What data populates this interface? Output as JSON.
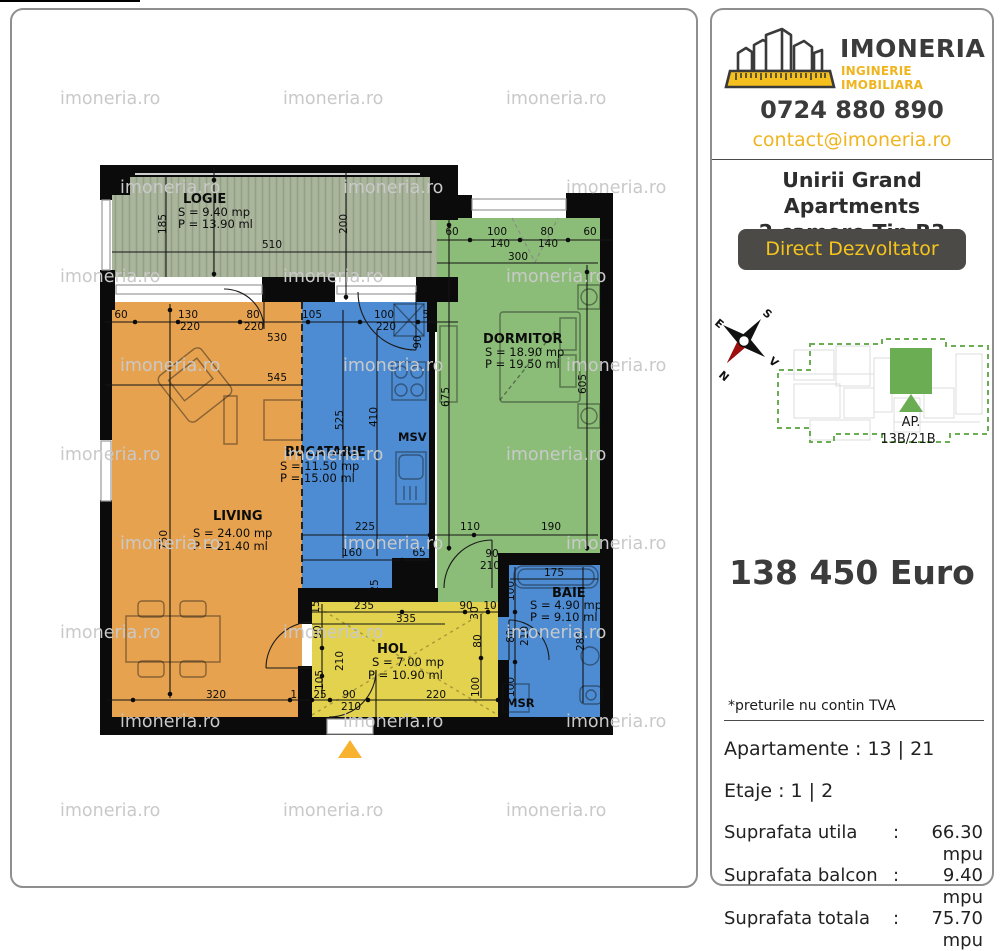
{
  "watermark": {
    "text": "imoneria.ro"
  },
  "sidebar": {
    "brand": {
      "name": "IMONERIA",
      "tagline": "INGINERIE IMOBILIARA"
    },
    "phone": "0724 880 890",
    "email": "contact@imoneria.ro",
    "project_title_line1": "Unirii Grand Apartments",
    "project_title_line2": "2 camere Tip B3",
    "badge_label": "Direct Dezvoltator",
    "compass": {
      "n": "N",
      "s": "S",
      "e": "E",
      "v": "V"
    },
    "minimap": {
      "ap_line1": "AP.",
      "ap_line2": "13B/21B"
    },
    "price": "138 450 Euro",
    "tva_note": "*preturile nu contin TVA",
    "apartments_row": "Apartamente : 13 | 21",
    "floors_row": "Etaje : 1 | 2",
    "areas": [
      {
        "label": "Suprafata utila",
        "colon": ":",
        "value": "66.30 mpu"
      },
      {
        "label": "Suprafata balcon",
        "colon": ":",
        "value": "9.40 mpu"
      },
      {
        "label": "Suprafata totala",
        "colon": ":",
        "value": "75.70 mpu"
      }
    ],
    "colors": {
      "accent_yellow": "#f0b41e",
      "dark_gray": "#4b4a47",
      "map_green": "#6aad53"
    }
  },
  "floorplan": {
    "rooms": [
      {
        "name": "LOGIE",
        "area": "S = 9.40 mp",
        "perimeter": "P = 13.90 ml",
        "color": "#aab59c"
      },
      {
        "name": "DORMITOR",
        "area": "S = 18.90 mp",
        "perimeter": "P = 19.50 ml",
        "color": "#8cbd78"
      },
      {
        "name": "BUCATARIE",
        "area": "S = 11.50 mp",
        "perimeter": "P = 15.00 ml",
        "color": "#4d8cd3"
      },
      {
        "name": "LIVING",
        "area": "S = 24.00 mp",
        "perimeter": "P = 21.40 ml",
        "color": "#e6a24f"
      },
      {
        "name": "HOL",
        "area": "S = 7.00 mp",
        "perimeter": "P = 10.90 ml",
        "color": "#e2d24d"
      },
      {
        "name": "BAIE",
        "area": "S = 4.90 mp",
        "perimeter": "P = 9.10 ml",
        "color": "#4d8cd3"
      }
    ],
    "annotations": {
      "msv": "MSV",
      "msr": "MSR"
    },
    "dimensions": [
      {
        "t": "185",
        "x": 166,
        "y": 224,
        "r": 1
      },
      {
        "t": "510",
        "x": 272,
        "y": 248
      },
      {
        "t": "200",
        "x": 347,
        "y": 224,
        "r": 1
      },
      {
        "t": "60",
        "x": 121,
        "y": 318
      },
      {
        "t": "130",
        "x": 188,
        "y": 318
      },
      {
        "t": "80",
        "x": 253,
        "y": 318
      },
      {
        "t": "105",
        "x": 312,
        "y": 318
      },
      {
        "t": "100",
        "x": 384,
        "y": 318
      },
      {
        "t": "55",
        "x": 429,
        "y": 318
      },
      {
        "t": "220",
        "x": 190,
        "y": 330
      },
      {
        "t": "220",
        "x": 254,
        "y": 330
      },
      {
        "t": "530",
        "x": 277,
        "y": 341
      },
      {
        "t": "220",
        "x": 386,
        "y": 330
      },
      {
        "t": "90",
        "x": 421,
        "y": 342,
        "r": 1
      },
      {
        "t": "60",
        "x": 452,
        "y": 235
      },
      {
        "t": "100",
        "x": 497,
        "y": 235
      },
      {
        "t": "80",
        "x": 547,
        "y": 235
      },
      {
        "t": "60",
        "x": 590,
        "y": 235
      },
      {
        "t": "140",
        "x": 500,
        "y": 247
      },
      {
        "t": "140",
        "x": 548,
        "y": 247
      },
      {
        "t": "300",
        "x": 518,
        "y": 260
      },
      {
        "t": "675",
        "x": 449,
        "y": 397,
        "r": 1
      },
      {
        "t": "605",
        "x": 586,
        "y": 384,
        "r": 1
      },
      {
        "t": "750",
        "x": 167,
        "y": 540,
        "r": 1
      },
      {
        "t": "545",
        "x": 277,
        "y": 381
      },
      {
        "t": "525",
        "x": 343,
        "y": 420,
        "r": 1
      },
      {
        "t": "410",
        "x": 377,
        "y": 417,
        "r": 1
      },
      {
        "t": "225",
        "x": 365,
        "y": 530
      },
      {
        "t": "110",
        "x": 470,
        "y": 530
      },
      {
        "t": "190",
        "x": 551,
        "y": 530
      },
      {
        "t": "160",
        "x": 352,
        "y": 556
      },
      {
        "t": "65",
        "x": 419,
        "y": 556
      },
      {
        "t": "25",
        "x": 378,
        "y": 586,
        "r": 1
      },
      {
        "t": "90",
        "x": 492,
        "y": 557
      },
      {
        "t": "210",
        "x": 490,
        "y": 569
      },
      {
        "t": "15",
        "x": 319,
        "y": 607,
        "r": 1
      },
      {
        "t": "90",
        "x": 321,
        "y": 632,
        "r": 1
      },
      {
        "t": "210",
        "x": 343,
        "y": 661,
        "r": 1
      },
      {
        "t": "105",
        "x": 323,
        "y": 680,
        "r": 1
      },
      {
        "t": "235",
        "x": 364,
        "y": 609
      },
      {
        "t": "335",
        "x": 406,
        "y": 622
      },
      {
        "t": "90",
        "x": 466,
        "y": 609
      },
      {
        "t": "30",
        "x": 478,
        "y": 613,
        "r": 1
      },
      {
        "t": "10",
        "x": 490,
        "y": 609
      },
      {
        "t": "80",
        "x": 481,
        "y": 641,
        "r": 1
      },
      {
        "t": "100",
        "x": 479,
        "y": 687,
        "r": 1
      },
      {
        "t": "320",
        "x": 216,
        "y": 698
      },
      {
        "t": "15",
        "x": 297,
        "y": 698
      },
      {
        "t": "25",
        "x": 320,
        "y": 698
      },
      {
        "t": "90",
        "x": 349,
        "y": 698
      },
      {
        "t": "210",
        "x": 351,
        "y": 710
      },
      {
        "t": "220",
        "x": 436,
        "y": 698
      },
      {
        "t": "175",
        "x": 554,
        "y": 576
      },
      {
        "t": "100",
        "x": 514,
        "y": 591,
        "r": 1
      },
      {
        "t": "80",
        "x": 514,
        "y": 636,
        "r": 1
      },
      {
        "t": "210",
        "x": 528,
        "y": 636,
        "r": 1
      },
      {
        "t": "100",
        "x": 514,
        "y": 687,
        "r": 1
      },
      {
        "t": "280",
        "x": 584,
        "y": 641,
        "r": 1
      }
    ]
  }
}
